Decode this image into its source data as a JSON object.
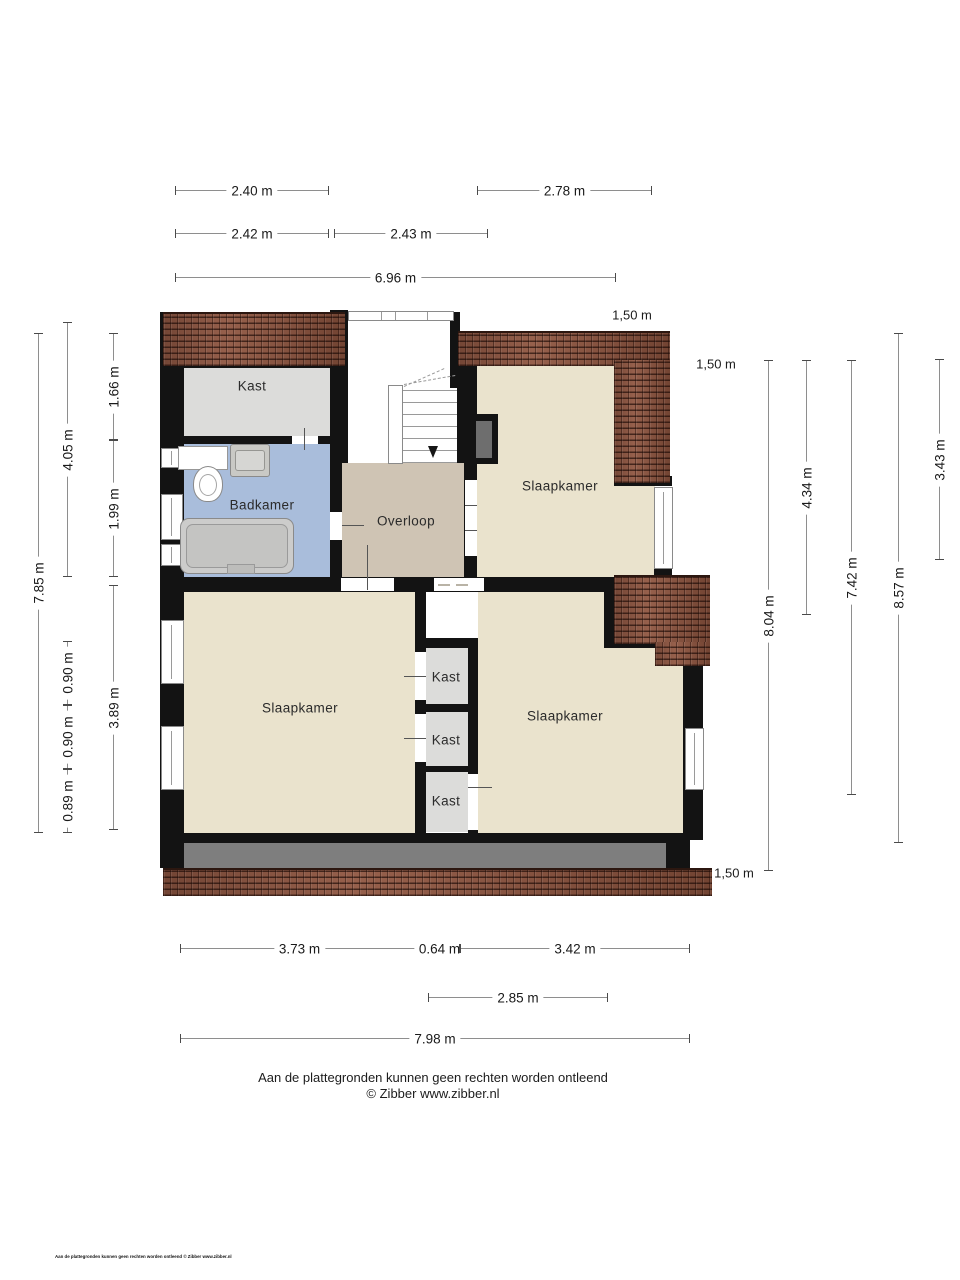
{
  "plan": {
    "type": "floorplan",
    "rooms": {
      "kast_attic": "Kast",
      "badkamer": "Badkamer",
      "overloop": "Overloop",
      "slaapkamer_ne": "Slaapkamer",
      "slaapkamer_sw": "Slaapkamer",
      "slaapkamer_se": "Slaapkamer",
      "kast_1": "Kast",
      "kast_2": "Kast",
      "kast_3": "Kast"
    },
    "dimensions": {
      "top": [
        "2.40 m",
        "2.78 m",
        "2.42 m",
        "2.43 m",
        "6.96 m"
      ],
      "bottom": [
        "3.73 m",
        "0.64 m",
        "3.42 m",
        "2.85 m",
        "7.98 m"
      ],
      "left": [
        "7.85 m",
        "4.05 m",
        "1.66 m",
        "1.99 m",
        "0.90 m",
        "0.90 m",
        "0.89 m",
        "3.89 m"
      ],
      "right": [
        "8.04 m",
        "4.34 m",
        "7.42 m",
        "8.57 m",
        "3.43 m"
      ],
      "roof": [
        "1,50 m",
        "1,50 m",
        "1,50 m"
      ]
    },
    "colors": {
      "wall": "#131313",
      "bedroom_floor": "#eae3cd",
      "closet_floor": "#dcdcda",
      "bathroom_floor": "#a9bddb",
      "landing_floor": "#cfc4b4",
      "dormer_gray": "#7e7e7e",
      "roof_tile": "#96604c",
      "dimension_line": "#8e8e8e"
    }
  },
  "footer": {
    "disclaimer": "Aan de plattegronden kunnen geen rechten worden ontleend",
    "copyright": "© Zibber www.zibber.nl",
    "fineprint": "Aan de plattegronden kunnen geen rechten worden ontleend © Zibber www.zibber.nl"
  }
}
